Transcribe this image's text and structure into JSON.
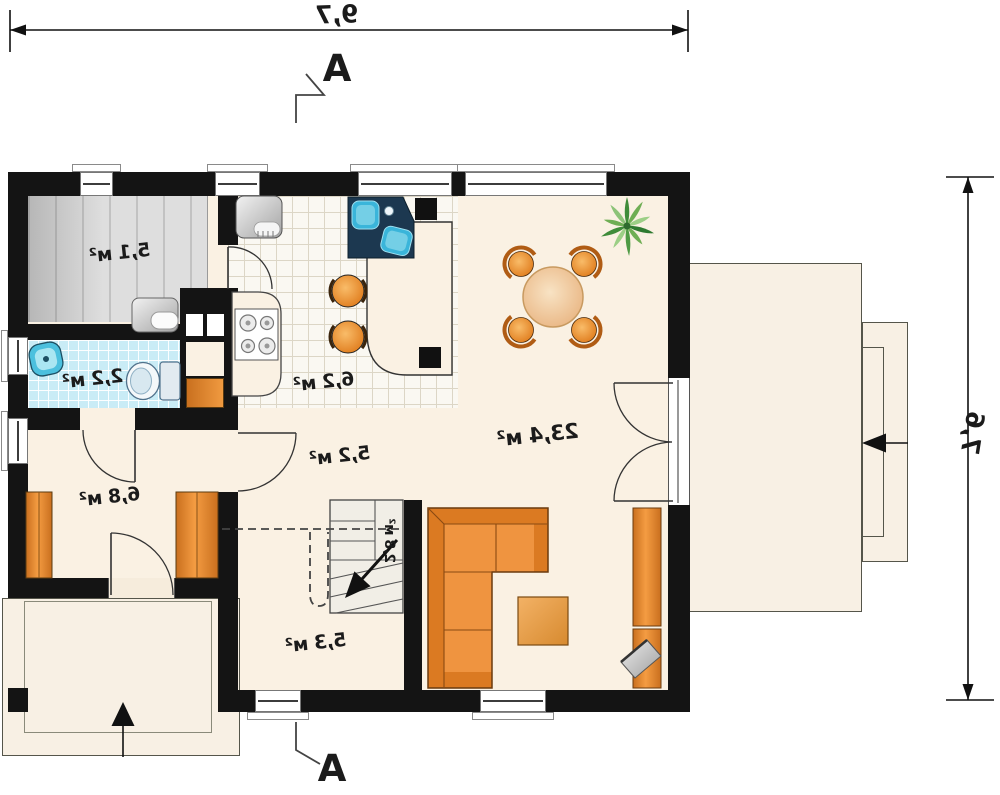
{
  "plan": {
    "width_dimension": "9,7",
    "height_dimension": "7,6",
    "section_marker": "A",
    "rooms": [
      {
        "name": "utility-room",
        "area": "5,1 м²"
      },
      {
        "name": "bathroom",
        "area": "2,2 м²"
      },
      {
        "name": "kitchen",
        "area": "6,2 м²"
      },
      {
        "name": "hall",
        "area": "5,2 м²"
      },
      {
        "name": "wardrobe-room",
        "area": "6,8 м²"
      },
      {
        "name": "living-room",
        "area": "23,4 м²"
      },
      {
        "name": "staircase",
        "area": "2,8 м²"
      },
      {
        "name": "vestibule",
        "area": "5,3 м²"
      }
    ],
    "furniture_icons": [
      "fridge-icon",
      "kitchen-sink-icon",
      "stove-icon",
      "bar-stool-icon",
      "dining-table-icon",
      "dining-chair-icon",
      "plant-icon",
      "sofa-icon",
      "coffee-table-icon",
      "tv-bench-icon",
      "tv-icon",
      "toilet-icon",
      "washbasin-icon",
      "water-heater-icon",
      "wardrobe-icon",
      "stairs-icon",
      "entrance-arrow-icon"
    ],
    "colors": {
      "wall": "#141414",
      "floor": "#faf1e3",
      "bathroom_tile": "#c9ecf6",
      "kitchen_tile": "#faf8f2",
      "utility_floor": "#dedede",
      "furniture_orange": "#e8872b",
      "water_blue": "#3ab5da",
      "terrace": "#f8f0e4",
      "plant_green": "#5aa14e"
    }
  }
}
